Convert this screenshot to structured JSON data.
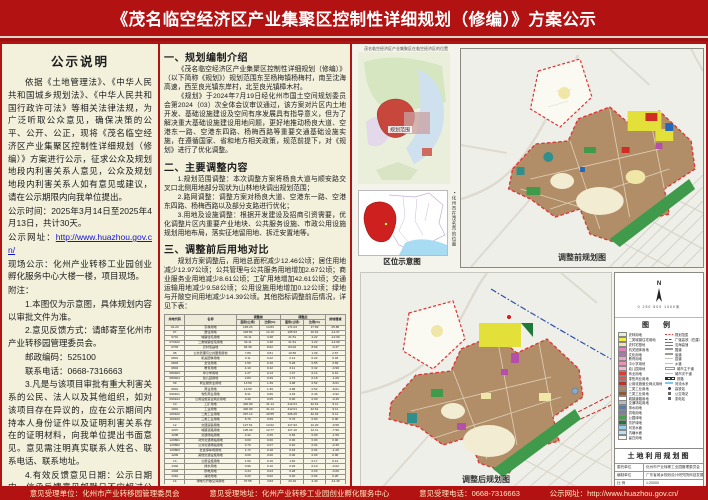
{
  "title": "《茂名临空经济区产业集聚区控制性详细规划（修编）》方案公示",
  "left_panel": {
    "heading": "公示说明",
    "paragraphs": [
      {
        "indent": true,
        "text": "依据《土地管理法》、《中华人民共和国城乡规划法》、《中华人民共和国行政许可法》等相关法律法规，为广泛听取公众意见，确保决策的公平、公开、公正，现将《茂名临空经济区产业集聚区控制性详细规划（修编）》方案进行公示，征求公众及规划地段内利害关系人意见，公众及规划地段内利害关系人如有意见或建议，请在公示期限内向我单位提出。"
      },
      {
        "indent": false,
        "text": "公示时间：2025年3月14日至2025年4月13日，共计30天。"
      },
      {
        "indent": false,
        "label": "公示网址：",
        "link": "http://www.huazhou.gov.cn/"
      },
      {
        "indent": false,
        "text": "现场公示：化州产业转移工业园创业孵化服务中心大楼一楼，项目现场。"
      },
      {
        "indent": false,
        "text": "附注："
      },
      {
        "indent": true,
        "text": "1.本图仅为示意图，具体规划内容以审批文件为准。"
      },
      {
        "indent": true,
        "text": "2.意见反馈方式：请邮寄至化州市产业转移园管理委员会。"
      },
      {
        "indent": true,
        "text": "邮政编码：525100"
      },
      {
        "indent": true,
        "text": "联系电话：0668-7316663"
      },
      {
        "indent": true,
        "text": "3.凡是与该项目审批有重大利害关系的公民、法人以及其他组织，如对该项目存在异议的，应在公示期间内持本人身份证件以及证明利害关系存在的证明材料，向我单位提出书面意见。意见需注明真实联系人姓名、联系电话、联系地址。"
      },
      {
        "indent": true,
        "text": "4.有效反馈意见日期：公示日期内，信函反馈意见邮戳日不应超过公示日期最后一天的24:00，逾期视为无效意见，不予采纳。"
      }
    ]
  },
  "middle_panel": {
    "sections": [
      {
        "heading": "一、规划编制介绍",
        "paragraphs": [
          "《茂名临空经济区产业集聚区控制性详细规划（修编）》（以下简称《规划》）规划范围东至杨梅镇杨梅村，南至沈海高速，西至良光镇东岸村，北至良光镇樟木村。",
          "《规划》于2024年7月19日经化州市国土空间规划委员会第2024（03）次全体会议审议通过，该方案对片区内土地开发、基础设施建设及空间有序发展具有指导意义，但为了解决重大基础设施建设用地问题，更好地推动杨良大道、空港东一路、空港东四路、杨梅西路等重要交通基础设施实施，在遵循国家、省和地方相关政策，规范前提下，对《规划》进行了优化调整。"
        ]
      },
      {
        "heading": "二、主要调整内容",
        "paragraphs": [
          "1.规划范围调整：本次调整方案将杨良大道与顺安路交叉口北侧用地部分现状为山林地块调出规划范围；",
          "2.路网调整：调整方案对杨良大道、空港东一路、空港东四路、杨梅西路以及部分支路进行优化；",
          "3.用地及设施调整：根据开发建设及招商引资需要，优化调整片区内重要产业地块、公共服务设施、市政公用设施规划用地布局，落实征地留用地、拆迁安置地等。"
        ]
      },
      {
        "heading": "三、调整前后用地对比",
        "paragraphs": [
          "规划方案调整后，用地总面积减少12.46公顷；居住用地减少12.97公顷；公共管理与公共服务用地增加2.67公顷；商业服务业用地减少8.61公顷；工矿用地增加42.61公顷；交通运输用地减少9.58公顷；公用设施用地增加0.12公顷；绿地与开敞空间用地减少14.39公顷。其他指标调整前后情况，详见下表："
        ]
      }
    ],
    "table": {
      "header": {
        "code": "用地代码",
        "name": "名称",
        "before": "调整前",
        "after": "调整后",
        "change": "用地增减",
        "area": "面积(公顷)",
        "pct": "比例(%)"
      },
      "rows": [
        [
          "01-23",
          "农林用地",
          "145.23",
          "14.83",
          "171.03",
          "17.69",
          "25.80"
        ],
        [
          "07",
          "居住用地",
          "118.50",
          "12.10",
          "105.53",
          "10.91",
          "-12.97"
        ],
        [
          "0701",
          "城镇住宅用地",
          "34.11",
          "3.48",
          "21.51",
          "2.22",
          "-12.60"
        ],
        [
          "070102",
          "二类城镇住宅用地",
          "34.11",
          "3.48",
          "21.51",
          "2.22",
          "-12.60"
        ],
        [
          "0703",
          "农村宅基地",
          "84.39",
          "8.62",
          "84.02",
          "8.69",
          "-0.37"
        ],
        [
          "08",
          "公共管理与公共服务用地",
          "7.89",
          "0.81",
          "10.56",
          "1.09",
          "2.67"
        ],
        [
          "0801",
          "机关团体用地",
          "2.11",
          "0.22",
          "2.14",
          "0.22",
          "0.03"
        ],
        [
          "0803",
          "文化用地",
          "1.59",
          "0.16",
          "5.28",
          "0.55",
          "3.69"
        ],
        [
          "0804",
          "教育用地",
          "4.10",
          "0.42",
          "3.11",
          "0.32",
          "-0.99"
        ],
        [
          "080403",
          "中小学用地",
          "1.27",
          "0.13",
          "1.37",
          "0.14",
          "0.10"
        ],
        [
          "080404",
          "幼儿园用地",
          "2.83",
          "0.29",
          "1.74",
          "0.18",
          "-1.09"
        ],
        [
          "09",
          "商业服务业用地",
          "13.59",
          "1.39",
          "4.98",
          "0.52",
          "-8.61"
        ],
        [
          "0901",
          "商业用地",
          "13.59",
          "1.39",
          "4.98",
          "0.52",
          "-8.61"
        ],
        [
          "090101",
          "零售商业用地",
          "8.41",
          "0.86",
          "4.49",
          "0.46",
          "-3.92"
        ],
        [
          "090104",
          "公用设施营业网点用地",
          "0.49",
          "0.05",
          "0.00",
          "0.00",
          "-0.49"
        ],
        [
          "10",
          "工矿用地",
          "402.90",
          "41.14",
          "412.01",
          "42.61",
          "9.11"
        ],
        [
          "1001",
          "工业用地",
          "402.90",
          "41.14",
          "412.01",
          "42.61",
          "9.11"
        ],
        [
          "100102",
          "二类工业用地",
          "397.14",
          "40.55",
          "406.25",
          "42.02",
          "9.11"
        ],
        [
          "100103",
          "三类工业用地",
          "5.76",
          "0.59",
          "5.76",
          "0.60",
          "0.00"
        ],
        [
          "12",
          "交通运输用地",
          "127.51",
          "13.02",
          "117.93",
          "12.20",
          "-9.58"
        ],
        [
          "1207",
          "城镇道路用地",
          "125.09",
          "12.77",
          "117.10",
          "12.11",
          "-7.99"
        ],
        [
          "1208",
          "交通场站用地",
          "2.42",
          "0.25",
          "0.83",
          "0.09",
          "-1.59"
        ],
        [
          "120801",
          "对外交通场站用地",
          "0.00",
          "0.00",
          "0.00",
          "0.00",
          "0.00"
        ],
        [
          "120802",
          "公共交通场站用地",
          "0.70",
          "0.07",
          "0.40",
          "0.04",
          "-0.30"
        ],
        [
          "120803",
          "社会停车场用地",
          "1.72",
          "0.18",
          "0.43",
          "0.04",
          "-1.29"
        ],
        [
          "1209",
          "其他交通设施用地",
          "0.00",
          "0.00",
          "0.00",
          "0.00",
          "0.00"
        ],
        [
          "13",
          "公用设施用地",
          "1.50",
          "0.15",
          "1.62",
          "0.17",
          "0.12"
        ],
        [
          "1302",
          "排水用地",
          "0.96",
          "0.10",
          "0.94",
          "0.10",
          "-0.02"
        ],
        [
          "1303",
          "供电用地",
          "0.34",
          "0.03",
          "0.28",
          "0.03",
          "-0.06"
        ],
        [
          "1310",
          "消防用地",
          "0.20",
          "0.02",
          "0.40",
          "0.04",
          "0.20"
        ],
        [
          "14",
          "绿地与开敞空间用地",
          "37.55",
          "3.83",
          "23.16",
          "2.40",
          "-14.39"
        ],
        [
          "1401",
          "公园绿地",
          "8.91",
          "0.91",
          "6.77",
          "0.70",
          "-2.14"
        ],
        [
          "1402",
          "防护绿地",
          "28.64",
          "2.92",
          "16.39",
          "1.70",
          "-12.25"
        ],
        [
          "16",
          "留白用地",
          "98.43",
          "10.05",
          "98.43",
          "10.18",
          "0.00"
        ],
        [
          "17",
          "陆地水域",
          "20.01",
          "2.04",
          "8.19",
          "0.85",
          "-11.82"
        ],
        [
          "1701",
          "河流水面",
          "20.01",
          "2.04",
          "6.56",
          "0.68",
          "-13.45"
        ],
        [
          "1704",
          "坑塘水面",
          "0.00",
          "0.00",
          "1.63",
          "0.17",
          "1.63"
        ]
      ],
      "total": [
        "合计",
        "979.29",
        "100.0000",
        "966.83",
        "100.0000",
        "-12.46"
      ]
    }
  },
  "right_panel": {
    "inset_caption_top": "茂名临空经济区产业集聚区在临空经济区的位置",
    "location_map_label": "规划范围",
    "inset_caption_bottom": "区位示意图",
    "vertical_caption": "▪化州市在茂名市的位置",
    "map_before_caption": "调整前规划图",
    "map_after_caption": "调整后规划图",
    "compass_letter": "N",
    "scale_text": "0  250  500      1000米",
    "legend_title": "图  例",
    "legend_items": [
      {
        "name": "农林用地",
        "color": "#e4efcf"
      },
      {
        "name": "二类城镇住宅用地",
        "color": "#f2ef3f"
      },
      {
        "name": "农村宅基地",
        "color": "#efe6a8"
      },
      {
        "name": "机关团体用地",
        "color": "#e183b9"
      },
      {
        "name": "文化用地",
        "color": "#b96cc0"
      },
      {
        "name": "教育用地",
        "color": "#f0a4c0"
      },
      {
        "name": "中小学用地",
        "color": "#ef8fb4"
      },
      {
        "name": "幼儿园用地",
        "color": "#f4b8cd"
      },
      {
        "name": "商业用地",
        "color": "#e23a2e"
      },
      {
        "name": "零售商业用地",
        "color": "#e85548"
      },
      {
        "name": "公用设施营业网点用地",
        "color": "#c03028"
      },
      {
        "name": "二类工业用地",
        "color": "#ba8256"
      },
      {
        "name": "三类工业用地",
        "color": "#8f5a33"
      },
      {
        "name": "城镇道路用地",
        "color": "#ffffff"
      },
      {
        "name": "交通场站用地",
        "color": "#b9b9b9"
      },
      {
        "name": "排水用地",
        "color": "#5a7fa5"
      },
      {
        "name": "供电用地",
        "color": "#7d7da8"
      },
      {
        "name": "公园绿地",
        "color": "#46a24a"
      },
      {
        "name": "防护绿地",
        "color": "#1f7a39"
      },
      {
        "name": "河流水面",
        "color": "#8fd0ee"
      },
      {
        "name": "坑塘水面",
        "color": "#b5e2f4"
      },
      {
        "name": "留白用地",
        "color": "#f7f7f2"
      }
    ],
    "legend_symbols": [
      {
        "name": "规划范围",
        "style": "red-dash"
      },
      {
        "name": "广湛高铁（在建）",
        "style": "blue-dash"
      },
      {
        "name": "沈海高速",
        "style": "double-line"
      },
      {
        "name": "国道",
        "style": "grey-line"
      },
      {
        "name": "省道",
        "style": "grey-line"
      },
      {
        "name": "县道",
        "style": "thin-line"
      },
      {
        "name": "乡道",
        "style": "thin-line"
      },
      {
        "name": "城市主干道",
        "style": "white-line"
      },
      {
        "name": "城市次干道",
        "style": "thin-line"
      },
      {
        "name": "铁路",
        "style": "rail-line"
      },
      {
        "name": "河流水系",
        "style": "blue-line"
      },
      {
        "name": "高铁站",
        "style": "dot"
      },
      {
        "name": "公交场站",
        "style": "square"
      },
      {
        "name": "变电站",
        "style": "square"
      }
    ],
    "titleblock": {
      "title": "土地利用规划图",
      "rows": [
        {
          "label": "委托单位",
          "value": "化州市产业转移工业园管理委员会"
        },
        {
          "label": "编制单位",
          "value": "广东省城乡规划设计研究院科技发展有限公司"
        },
        {
          "label": "比  例",
          "value": "1:20000"
        }
      ]
    }
  },
  "footer": {
    "items": [
      {
        "label": "意见受理单位：",
        "value": "化州市产业转移园管理委员会"
      },
      {
        "label": "意见受理地址：",
        "value": "化州产业转移工业园创业孵化服务中心"
      },
      {
        "label": "意见受理电话：",
        "value": "0668-7316663"
      },
      {
        "label": "公示网址：",
        "value": "http://www.huazhou.gov.cn/"
      }
    ]
  }
}
